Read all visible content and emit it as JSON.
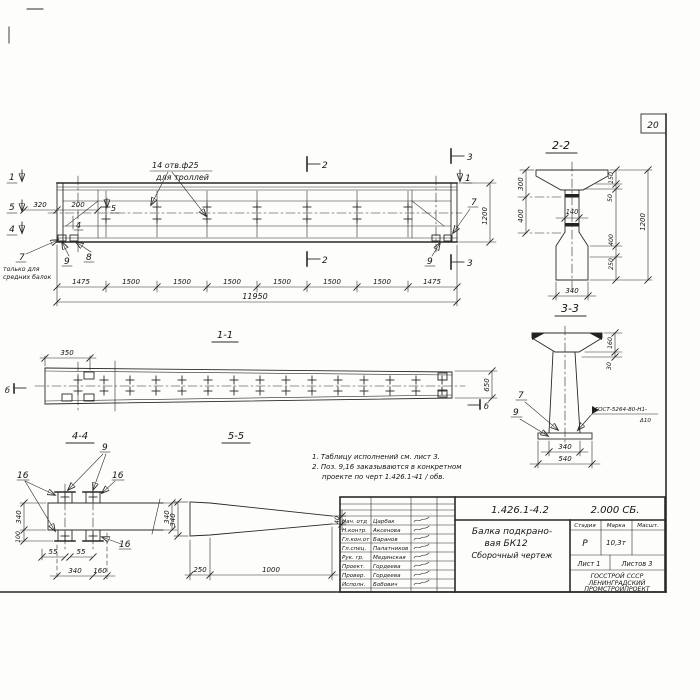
{
  "sheet": {
    "number": "20"
  },
  "main_view": {
    "hole_note": {
      "line1": "14 отв.ф25",
      "line2": "для троллей"
    },
    "markers": {
      "m1": "1",
      "m5": "5",
      "m4": "4",
      "m2": "2",
      "m3": "3",
      "b": "б"
    },
    "pos": {
      "p7": "7",
      "p8": "8",
      "p9": "9"
    },
    "pos7_note": {
      "line1": "только для",
      "line2": "средних балок"
    },
    "dims": {
      "d320": "320",
      "d200": "200",
      "d1200": "1200",
      "total": "11950",
      "chain": [
        "1475",
        "1500",
        "1500",
        "1500",
        "1500",
        "1500",
        "1500",
        "1475"
      ]
    }
  },
  "view_1_1": {
    "label": "1-1",
    "dims": {
      "d350": "350",
      "d650": "650"
    }
  },
  "view_4_4": {
    "label": "4-4",
    "pos": {
      "p9": "9",
      "p16": "16"
    },
    "dims": {
      "d340": "340",
      "d100": "100",
      "d55": "55",
      "d160": "160"
    }
  },
  "view_5_5": {
    "label": "5-5",
    "dims": {
      "d340": "340",
      "d250": "250",
      "d1000": "1000",
      "d40": "40"
    }
  },
  "notes": {
    "line1": "1. Таблицу исполнений см. лист 3.",
    "line2": "2. Поз. 9,16 заказываются в конкретном",
    "line3": "проекте по черт 1.426.1-41 / обв."
  },
  "section_2_2": {
    "label": "2-2",
    "dims": {
      "d300": "300",
      "d400": "400",
      "d140": "140",
      "d150": "150",
      "d50": "50",
      "d1200": "1200",
      "d250": "250",
      "d340": "340"
    }
  },
  "section_3_3": {
    "label": "3-3",
    "pos": {
      "p7": "7",
      "p9": "9"
    },
    "weld": {
      "line1": "ГОСТ-5264-80-Н1-",
      "line2": "Δ10"
    },
    "dims": {
      "d160": "160",
      "d30": "30",
      "d340": "340",
      "d540": "540"
    }
  },
  "title_block": {
    "doc_number": "1.426.1-4.2",
    "doc_code": "2.000 СБ.",
    "title": {
      "line1": "Балка подкрано-",
      "line2": "вая БК12",
      "line3": "Сборочный чертеж"
    },
    "header": {
      "stage": "Стадия",
      "mark": "Марка",
      "scale": "Масшт."
    },
    "values": {
      "stage": "Р",
      "mass": "10,3т"
    },
    "sheet_info": {
      "sheet": "Лист 1",
      "sheets": "Листов 3"
    },
    "org": {
      "line1": "ГОССТРОЙ СССР",
      "line2": "ЛЕНИНГРАДСКИЙ",
      "line3": "ПРОМСТРОЙПРОЕКТ"
    },
    "signature_rows": [
      {
        "role": "Нач. отд",
        "name": "Царбак"
      },
      {
        "role": "Н.контр.",
        "name": "Аксенова"
      },
      {
        "role": "Гл.кон.от",
        "name": "Баранов"
      },
      {
        "role": "Гл.спец.",
        "name": "Палатников"
      },
      {
        "role": "Рук. гр.",
        "name": "Мединская"
      },
      {
        "role": "Проект.",
        "name": "Гордеева"
      },
      {
        "role": "Провер.",
        "name": "Гордеева"
      },
      {
        "role": "Исполн.",
        "name": "Бобович"
      }
    ]
  }
}
